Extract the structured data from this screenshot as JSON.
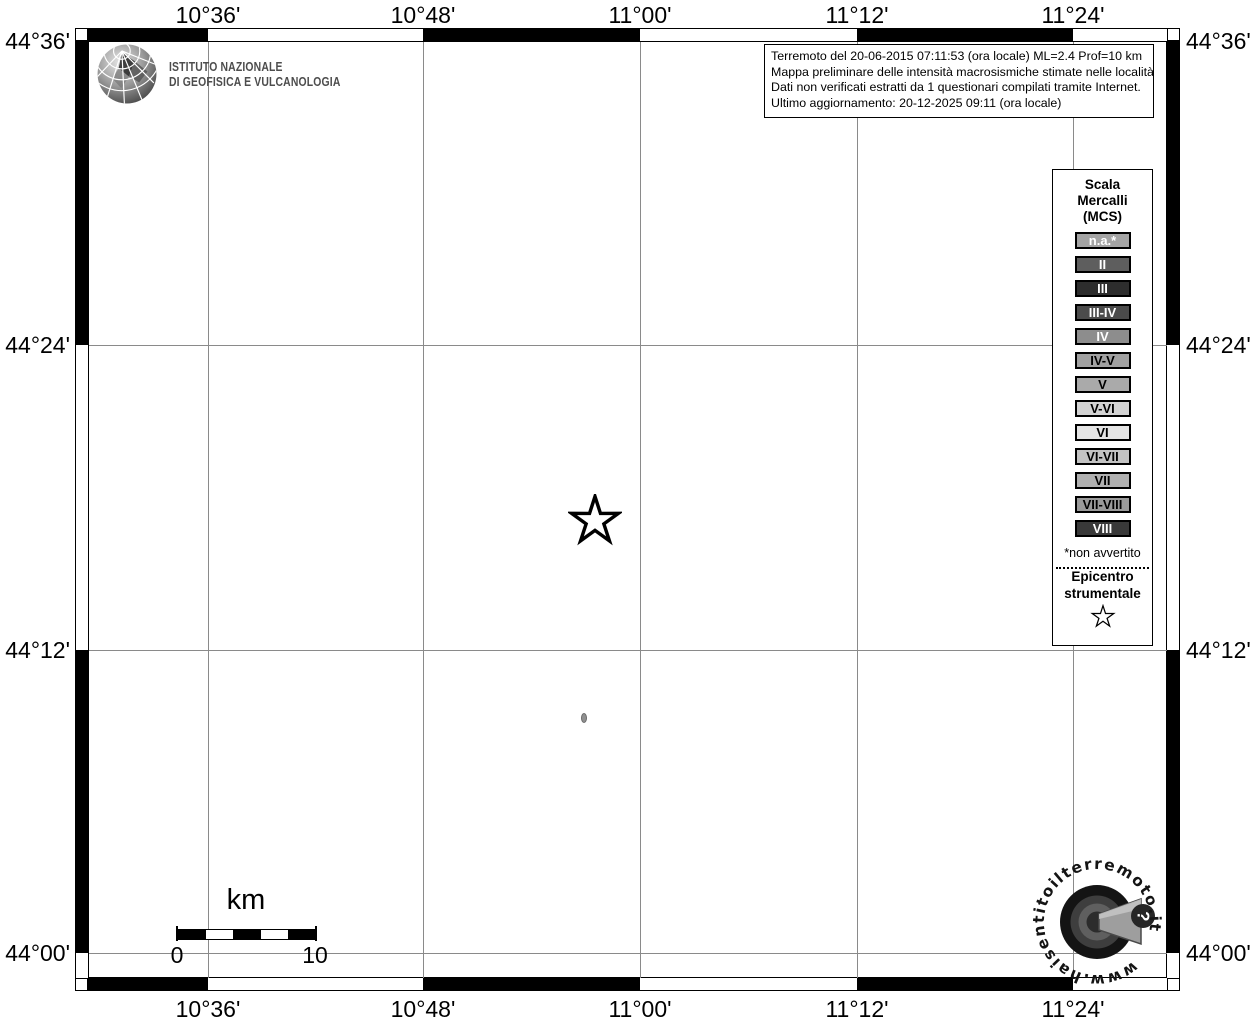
{
  "info_box": {
    "lines": [
      "Terremoto del 20-06-2015 07:11:53 (ora locale) ML=2.4 Prof=10 km",
      "Mappa preliminare delle intensità macrosismiche stimate nelle località",
      "Dati non verificati estratti da 1 questionari compilati tramite Internet.",
      "Ultimo aggiornamento: 20-12-2025 09:11 (ora locale)"
    ]
  },
  "ingv": {
    "line1": "ISTITUTO NAZIONALE",
    "line2": "DI GEOFISICA E VULCANOLOGIA"
  },
  "axes": {
    "top": [
      "10°36'",
      "10°48'",
      "11°00'",
      "11°12'",
      "11°24'"
    ],
    "bottom": [
      "10°36'",
      "10°48'",
      "11°00'",
      "11°12'",
      "11°24'"
    ],
    "left": [
      "44°36'",
      "44°24'",
      "44°12'",
      "44°00'"
    ],
    "right": [
      "44°36'",
      "44°24'",
      "44°12'",
      "44°00'"
    ]
  },
  "legend": {
    "title_lines": [
      "Scala",
      "Mercalli",
      "(MCS)"
    ],
    "items": [
      {
        "label": "n.a.*",
        "bg": "#a4a4a4",
        "fg": "#ffffff"
      },
      {
        "label": "II",
        "bg": "#5e5e5e",
        "fg": "#ffffff"
      },
      {
        "label": "III",
        "bg": "#2d2d2d",
        "fg": "#ffffff"
      },
      {
        "label": "III-IV",
        "bg": "#4b4b4b",
        "fg": "#ffffff"
      },
      {
        "label": "IV",
        "bg": "#8d8d8d",
        "fg": "#ffffff"
      },
      {
        "label": "IV-V",
        "bg": "#a1a1a1",
        "fg": "#000000"
      },
      {
        "label": "V",
        "bg": "#aaaaaa",
        "fg": "#000000"
      },
      {
        "label": "V-VI",
        "bg": "#d3d3d3",
        "fg": "#000000"
      },
      {
        "label": "VI",
        "bg": "#e4e4e4",
        "fg": "#000000"
      },
      {
        "label": "VI-VII",
        "bg": "#c3c3c3",
        "fg": "#000000"
      },
      {
        "label": "VII",
        "bg": "#b0b0b0",
        "fg": "#000000"
      },
      {
        "label": "VII-VIII",
        "bg": "#9a9a9a",
        "fg": "#000000"
      },
      {
        "label": "VIII",
        "bg": "#393939",
        "fg": "#ffffff"
      }
    ],
    "footnote": "*non avvertito",
    "epicentro_line1": "Epicentro",
    "epicentro_line2": "strumentale"
  },
  "scalebar": {
    "unit": "km",
    "start": "0",
    "end": "10"
  },
  "watermark": {
    "text": "www.haisentitoilterremoto.it",
    "question_mark": "?"
  },
  "colors": {
    "gridline": "#8a8a8a",
    "frame": "#000000",
    "map_background": "#ffffff",
    "ingv_text": "#4d4d4d",
    "locality_na": "#909090"
  }
}
